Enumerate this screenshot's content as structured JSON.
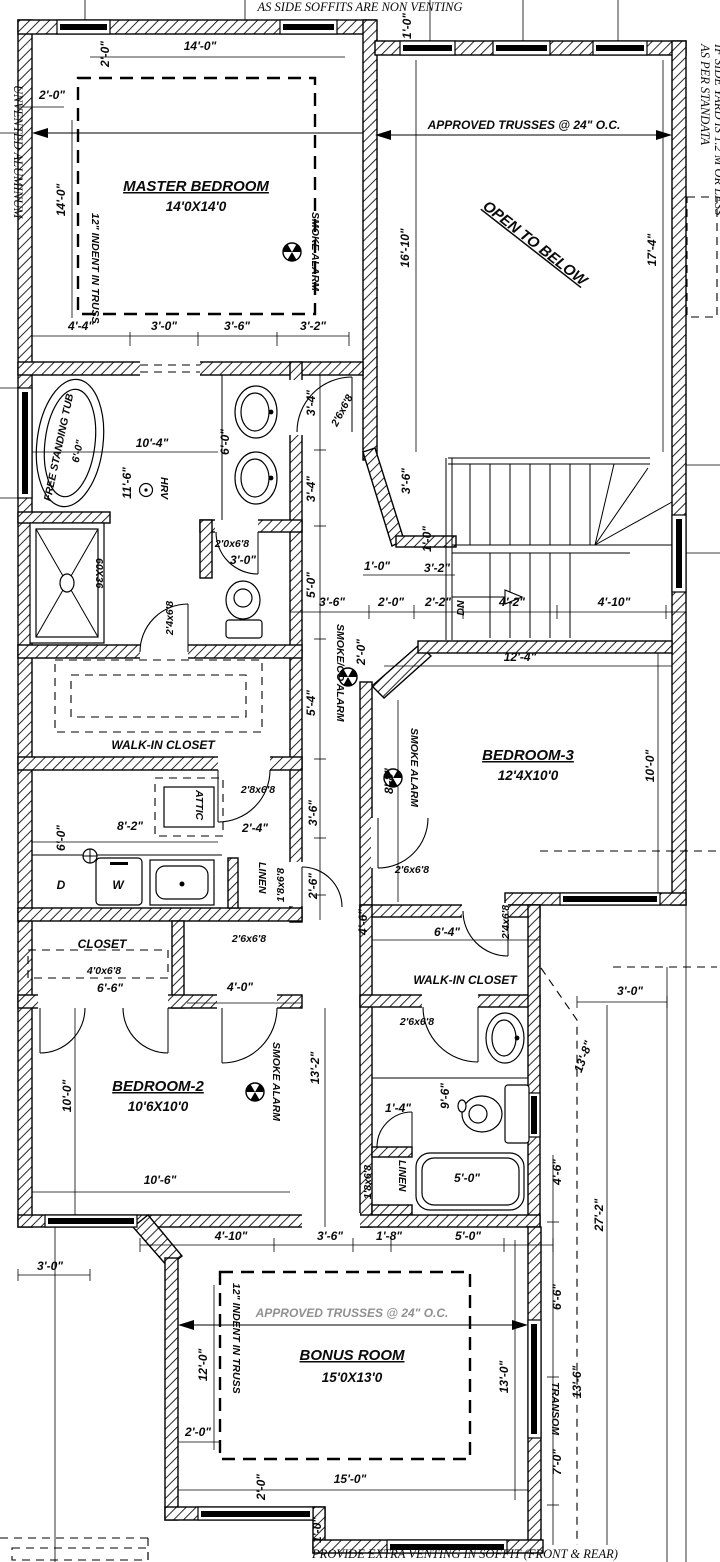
{
  "notes": {
    "top": "AS SIDE SOFFITS ARE NON VENTING",
    "left": "UNVENTED ALUMINUM",
    "right1": "AS PER STANDATA",
    "right2": "IF SIDE YARD IS 1.2 M OR LESS",
    "bottom": "PROVIDE EXTRA VENTING IN SOFFIT (FRONT & REAR)"
  },
  "annotations": {
    "trusses_top": "APPROVED TRUSSES @ 24\" O.C.",
    "trusses_bonus": "APPROVED TRUSSES @ 24\" O.C.",
    "indent_master": "12\" INDENT IN TRUSS",
    "indent_bonus": "12\" INDENT IN TRUSS",
    "open_below": "OPEN TO BELOW",
    "dn": "DN",
    "transom": "TRANSOM",
    "hrv": "HRV",
    "shower_size": "60X36",
    "washer": "W",
    "dryer": "D",
    "tub_label": "FREE STANDING TUB",
    "tub_size": "6'-0\"",
    "smoke": "SMOKE ALARM",
    "smoke_co": "SMOKE/CO ALARM"
  },
  "rooms": {
    "master_name": "MASTER BEDROOM",
    "master_size": "14'0X14'0",
    "bedroom3_name": "BEDROOM-3",
    "bedroom3_size": "12'4X10'0",
    "bedroom2_name": "BEDROOM-2",
    "bedroom2_size": "10'6X10'0",
    "bonus_name": "BONUS ROOM",
    "bonus_size": "15'0X13'0",
    "wic_master": "WALK-IN CLOSET",
    "wic_bed3": "WALK-IN CLOSET",
    "closet": "CLOSET",
    "linen_upper": "LINEN",
    "linen_lower": "LINEN",
    "attic": "ATTIC"
  },
  "doors": {
    "ensuite_hall": "2'6x6'8",
    "wc": "2'0x6'8",
    "wc_width": "3'-0\"",
    "ensuite": "2'4x6'8",
    "laundry": "2'8x6'8",
    "linen_upper": "1'8x6'8",
    "bed2_hall": "2'6x6'8",
    "closet_double": "4'0x6'8",
    "bed3": "2'6x6'8",
    "bed3_wic": "2'4x6'8",
    "bath": "2'6x6'8",
    "linen_lower": "1'8x6'8"
  },
  "dims": {
    "a1": "2'-0\"",
    "a2": "14'-0\"",
    "a3": "1'-0\"",
    "a4": "2'-0\"",
    "a5": "14'-0\"",
    "a6": "16'-10\"",
    "a7": "17'-4\"",
    "a8": "4'-4\"",
    "a9": "3'-0\"",
    "a10": "3'-6\"",
    "a11": "3'-2\"",
    "b1": "10'-4\"",
    "b2": "6'-0\"",
    "b3": "3'-4\"",
    "b4": "3'-4\"",
    "b5": "11'-6\"",
    "b6": "3'-6\"",
    "b7": "1'-0\"",
    "b8": "1'-0\"",
    "b9": "3'-2\"",
    "b10": "5'-0\"",
    "b11": "3'-6\"",
    "b12": "2'-0\"",
    "b13": "2'-2\"",
    "b14": "4'-2\"",
    "b15": "4'-10\"",
    "b16": "2'-0\"",
    "b17": "5'-4\"",
    "b18": "3'-0\"",
    "c1": "12'-4\"",
    "c2": "8'-8\"",
    "c3": "10'-0\"",
    "c4": "3'-6\"",
    "c5": "8'-2\"",
    "c6": "6'-0\"",
    "c7": "2'-4\"",
    "c8": "2'-6\"",
    "c9": "6'-4\"",
    "c10": "4'-6\"",
    "c11": "3'-0\"",
    "c12": "6'-6\"",
    "c13": "4'-0\"",
    "c14": "13'-8\"",
    "d1": "10'-0\"",
    "d2": "13'-2\"",
    "d3": "1'-4\"",
    "d4": "9'-6\"",
    "d5": "10'-6\"",
    "d6": "5'-0\"",
    "d7": "4'-6\"",
    "d8": "27'-2\"",
    "d9": "4'-10\"",
    "d10": "3'-6\"",
    "d11": "1'-8\"",
    "d12": "5'-0\"",
    "e1": "3'-0\"",
    "e2": "12'-0\"",
    "e3": "2'-0\"",
    "e4": "2'-0\"",
    "e5": "15'-0\"",
    "e6": "13'-0\"",
    "e7": "13'-6\"",
    "e8": "6'-6\"",
    "e9": "7'-0\"",
    "e10": "1'-0\""
  }
}
